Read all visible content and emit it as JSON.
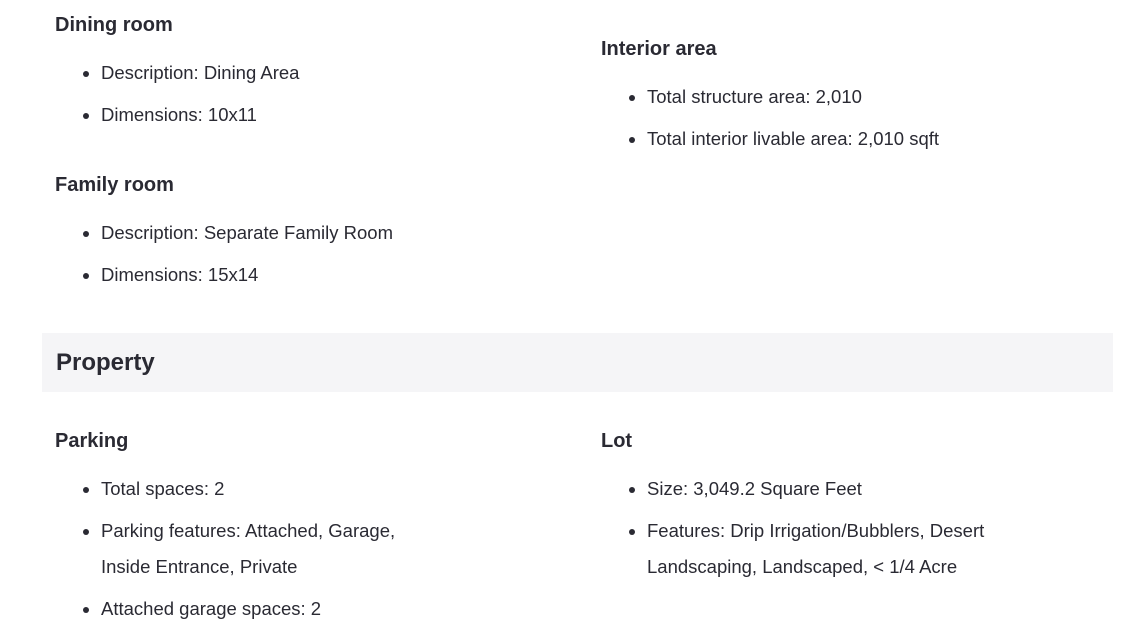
{
  "colors": {
    "text": "#2a2a33",
    "section_header_bg": "#f5f5f7",
    "page_bg": "#ffffff"
  },
  "facts_top": {
    "left": [
      {
        "title": "Dining room",
        "items": [
          "Description: Dining Area",
          "Dimensions: 10x11"
        ]
      },
      {
        "title": "Family room",
        "items": [
          "Description: Separate Family Room",
          "Dimensions: 15x14"
        ]
      }
    ],
    "right": [
      {
        "title": "Interior area",
        "items": [
          "Total structure area: 2,010",
          "Total interior livable area: 2,010 sqft"
        ]
      }
    ]
  },
  "section_header": {
    "label": "Property"
  },
  "facts_bottom": {
    "left": [
      {
        "title": "Parking",
        "items": [
          "Total spaces: 2",
          "Parking features: Attached, Garage, Inside Entrance, Private",
          "Attached garage spaces: 2"
        ]
      }
    ],
    "right": [
      {
        "title": "Lot",
        "items": [
          "Size: 3,049.2 Square Feet",
          "Features: Drip Irrigation/Bubblers, Desert Landscaping, Landscaped, < 1/4 Acre"
        ]
      }
    ]
  }
}
